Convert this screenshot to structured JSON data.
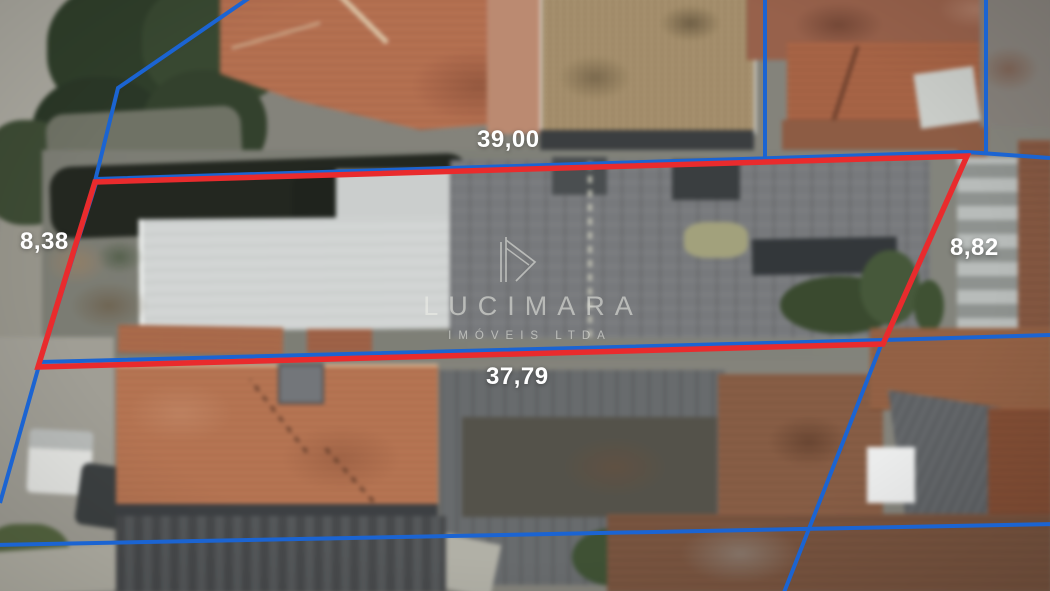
{
  "annotations": {
    "measurements": [
      {
        "side": "top",
        "label": "39,00"
      },
      {
        "side": "left",
        "label": "8,38"
      },
      {
        "side": "right",
        "label": "8,82"
      },
      {
        "side": "bottom",
        "label": "37,79"
      }
    ],
    "lot_line_color": "#e92b2d",
    "boundary_line_color": "#1b64d2",
    "label_color": "#ffffff"
  },
  "watermark": {
    "name": "LUCIMARA",
    "subtitle": "IMÓVEIS LTDA",
    "icon": "house-monogram-icon",
    "color": "#f0f1ea"
  }
}
